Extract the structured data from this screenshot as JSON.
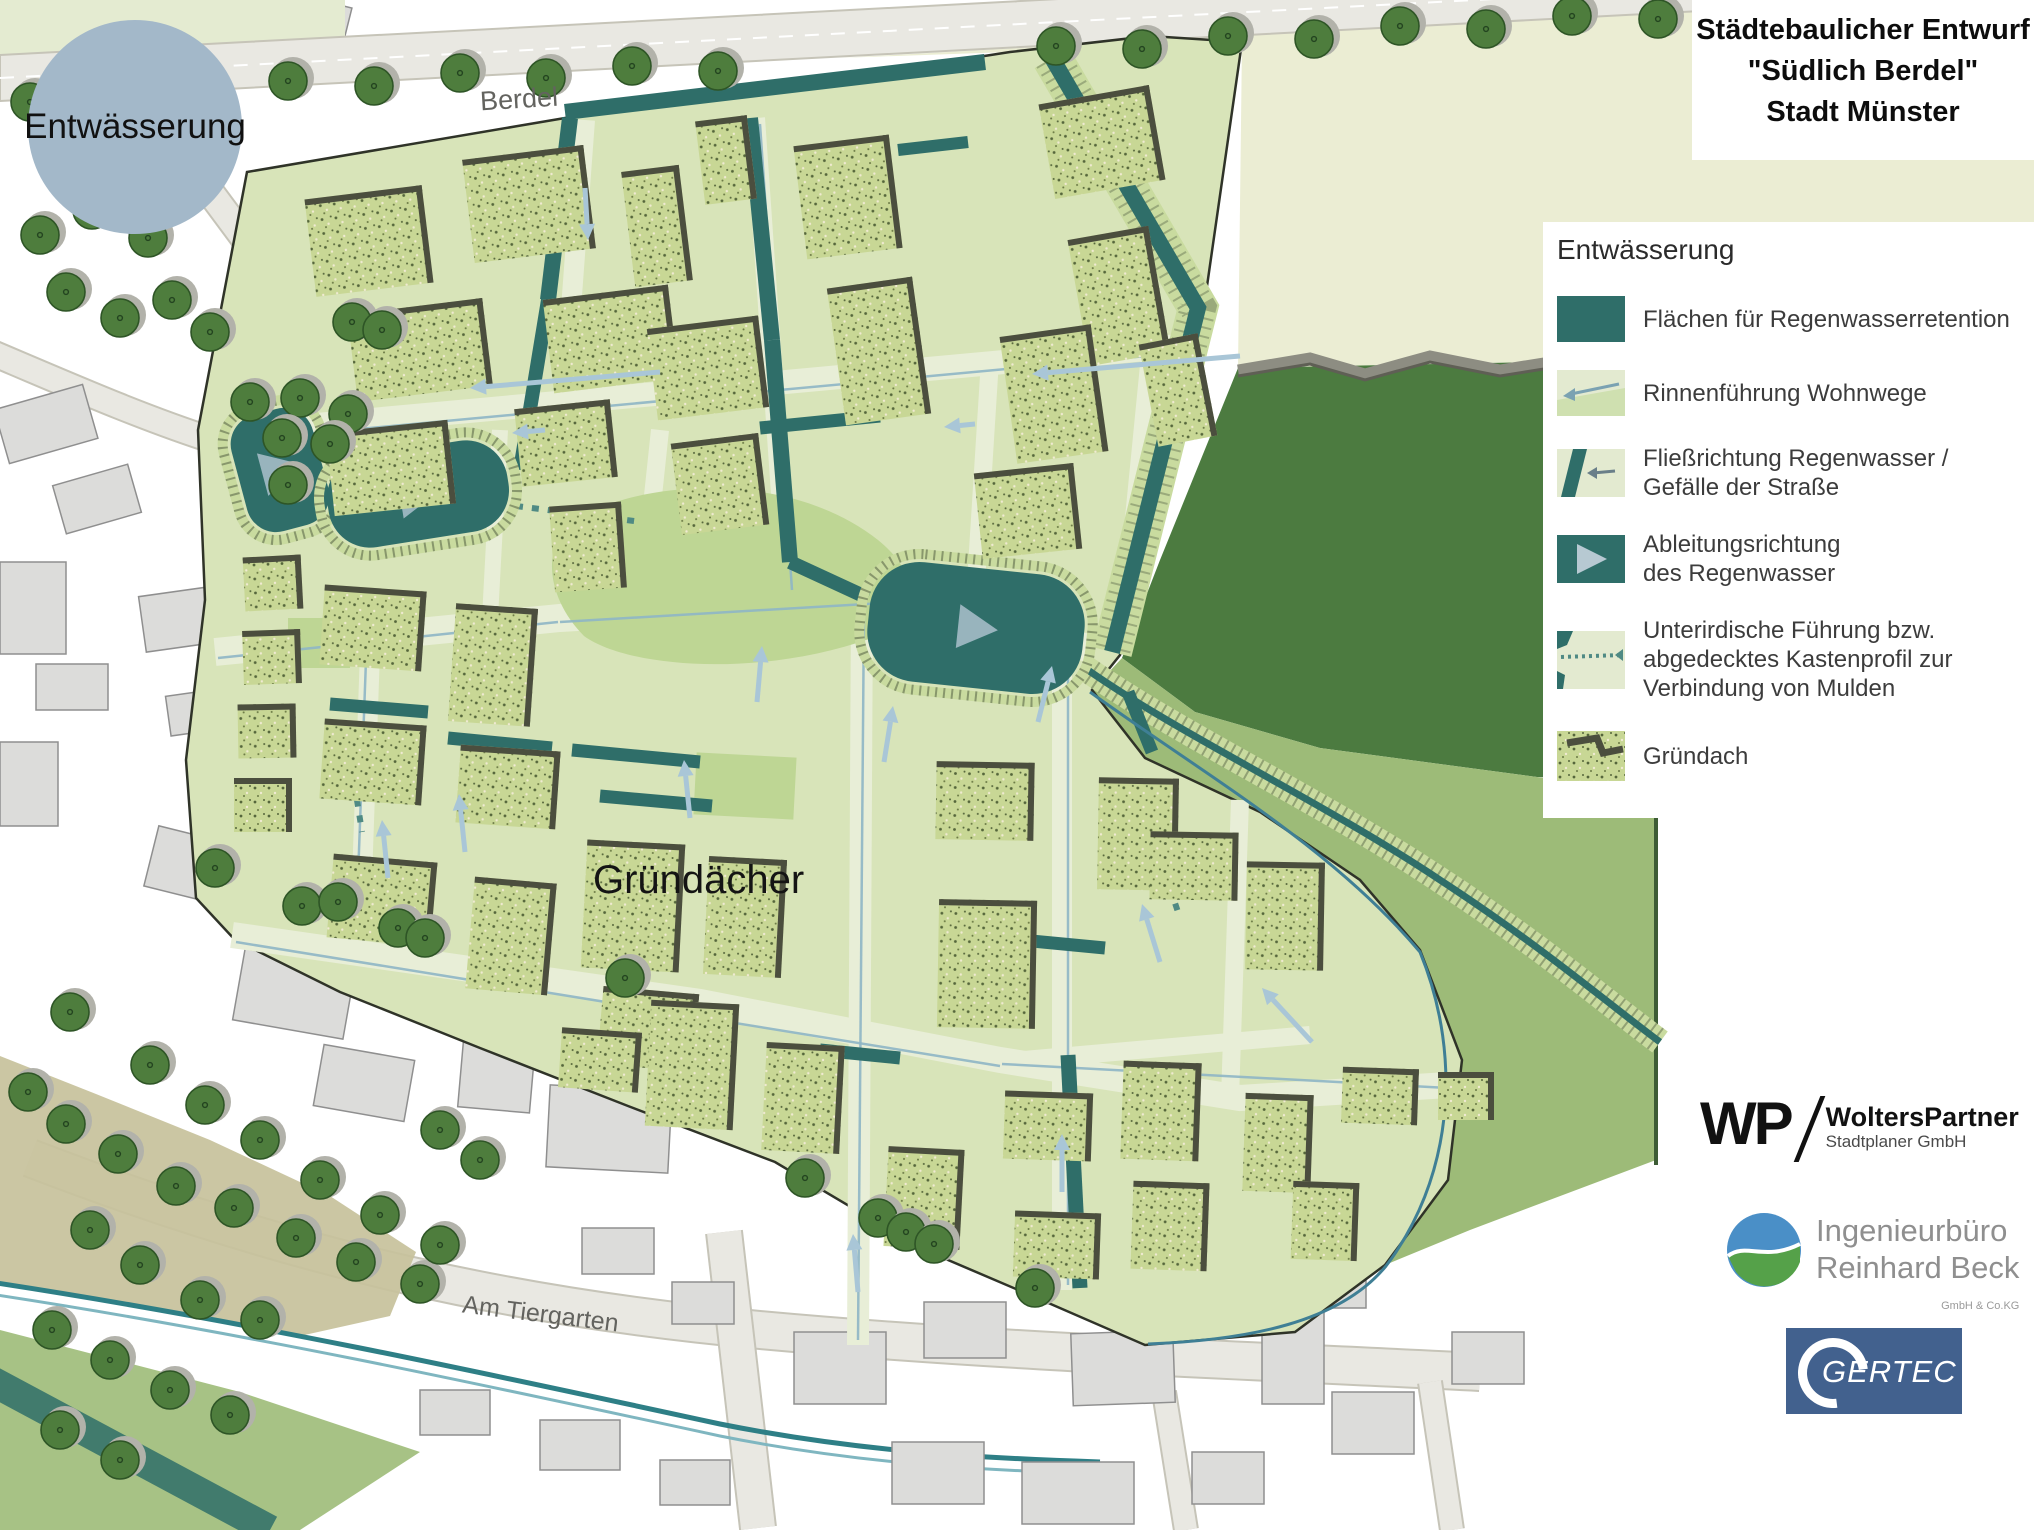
{
  "title": {
    "line1": "Städtebaulicher Entwurf",
    "line2": "\"Südlich Berdel\"",
    "line3": "Stadt Münster"
  },
  "badge": {
    "label": "Entwässerung"
  },
  "map_labels": {
    "street_top": "Berdel",
    "green_roofs": "Gründächer",
    "street_bottom": "Am Tiergarten"
  },
  "legend": {
    "title": "Entwässerung",
    "items": [
      {
        "icon": "retention-area-swatch",
        "lines": [
          "Flächen für Regenwasserretention"
        ]
      },
      {
        "icon": "channel-path-swatch",
        "lines": [
          "Rinnenführung Wohnwege"
        ]
      },
      {
        "icon": "flow-direction-swatch",
        "lines": [
          "Fließrichtung Regenwasser /",
          "Gefälle der Straße"
        ]
      },
      {
        "icon": "discharge-direction-swatch",
        "lines": [
          "Ableitungsrichtung",
          "des Regenwasser"
        ]
      },
      {
        "icon": "underground-duct-swatch",
        "lines": [
          "Unterirdische Führung bzw.",
          "abgedecktes Kastenprofil zur",
          "Verbindung von Mulden"
        ]
      },
      {
        "icon": "green-roof-swatch",
        "lines": [
          "Gründach"
        ]
      }
    ]
  },
  "logos": {
    "wp": {
      "initials": "WP",
      "name": "WoltersPartner",
      "subtitle": "Stadtplaner GmbH"
    },
    "beck": {
      "line1": "Ingenieurbüro",
      "line2": "Reinhard Beck",
      "subtitle": "GmbH & Co.KG"
    },
    "gertec": {
      "name": "GERTEC"
    }
  },
  "colors": {
    "teal": "#2f6e69",
    "siteGreen": "#d8e4b9",
    "paleStreet": "#e8eed7",
    "roofGreen": "#c8d795",
    "roofShadow": "#4b4e3e",
    "forest": "#4c7b40",
    "meadow": "#9dbb78",
    "cream": "#ebedd3",
    "creamStrip": "#e4ebd1",
    "roadGray": "#e9e8e2",
    "roadEdge": "#c6c4b8",
    "buildingGray": "#dcdcda",
    "buildingEdge": "#8f8f8f",
    "treeGreen": "#4e7d3d",
    "treeEdge": "#2e5526",
    "treeRim": "#b2b2aa",
    "arrowBlue": "#a9c6d7",
    "gutterBlue": "#8fb6c6",
    "badgeBlue": "#a3b8c9",
    "rimGreen": "#c9db9f",
    "hatchOlive": "#6c7a57",
    "boundaryDark": "#2f3328",
    "khaki": "#c7c19b",
    "streamTeal": "#2e7f86",
    "blueLine": "#3f7f95",
    "dotTeal": "#4f8a84",
    "beckBlue": "#4a8fc7",
    "beckGreen": "#55a149",
    "gertecBlue": "#42618e"
  }
}
